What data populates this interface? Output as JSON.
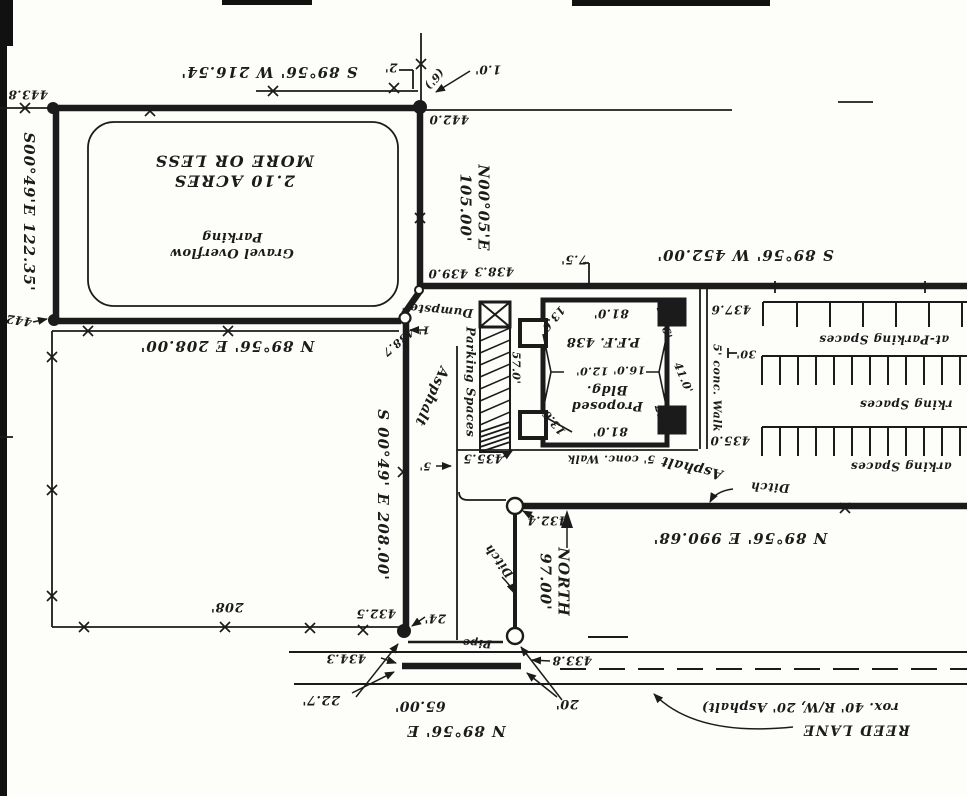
{
  "document": {
    "type": "scanned survey plat / site plan (sheet rotated 180 degrees)",
    "road_name": "REED LANE",
    "parcel_area": "2.10 ACRES MORE OR LESS",
    "ink_color": "#1b1b1b",
    "paper_color": "#fdfdfa"
  },
  "labels": [
    {
      "n": "bearing-top-boundary",
      "t": "S 89°56' W 216.54'",
      "x": 269,
      "y": 72,
      "r": 180,
      "s": 15,
      "ls": 1
    },
    {
      "n": "elev-443-8",
      "t": "443.8",
      "x": 28,
      "y": 94,
      "r": 180,
      "s": 12
    },
    {
      "n": "bearing-west-boundary",
      "t": "S00°49'E 122.35'",
      "x": 29,
      "y": 212,
      "r": 90,
      "s": 15,
      "ls": 1
    },
    {
      "n": "dim-2ft-fence-offset",
      "t": "2'",
      "x": 391,
      "y": 67,
      "r": 180,
      "s": 12
    },
    {
      "n": "dim-6ft-note",
      "t": "(6')",
      "x": 434,
      "y": 79,
      "r": 131,
      "s": 11
    },
    {
      "n": "dim-1-0ft",
      "t": "1.0'",
      "x": 488,
      "y": 69,
      "r": 180,
      "s": 12
    },
    {
      "n": "elev-442-0",
      "t": "442.0",
      "x": 449,
      "y": 119,
      "r": 180,
      "s": 12
    },
    {
      "n": "bearing-ne-boundary",
      "t": "N00°05'E\n105.00'",
      "x": 474,
      "y": 208,
      "r": 90,
      "s": 15,
      "ls": 1
    },
    {
      "n": "parcel-area-note",
      "t": "2.10 ACRES\nMORE OR LESS",
      "x": 234,
      "y": 171,
      "r": 180,
      "s": 16,
      "ls": 1.5
    },
    {
      "n": "parcel-use-note",
      "t": "Gravel Overflow\nParking",
      "x": 232,
      "y": 244,
      "r": 180,
      "s": 13
    },
    {
      "n": "elev-442",
      "t": "442",
      "x": 19,
      "y": 320,
      "r": 188,
      "s": 12
    },
    {
      "n": "bearing-n8956e-208",
      "t": "N 89°56' E 208.00'",
      "x": 227,
      "y": 346,
      "r": 180,
      "s": 15,
      "ls": 1
    },
    {
      "n": "elev-438-7",
      "t": "438.7",
      "x": 398,
      "y": 342,
      "r": 140,
      "s": 11
    },
    {
      "n": "bearing-s0049e-208",
      "t": "S 00°49' E 208.00'",
      "x": 383,
      "y": 495,
      "r": 90,
      "s": 15,
      "ls": 1
    },
    {
      "n": "dim-208",
      "t": "208'",
      "x": 227,
      "y": 606,
      "r": 180,
      "s": 13
    },
    {
      "n": "dumpster-label",
      "t": "Dumpster",
      "x": 438,
      "y": 310,
      "r": 185,
      "s": 12
    },
    {
      "n": "dim-1ft",
      "t": "1'",
      "x": 424,
      "y": 330,
      "r": 180,
      "s": 11
    },
    {
      "n": "parking-strip-label",
      "t": "Parking Spaces",
      "x": 470,
      "y": 382,
      "r": 90,
      "s": 12
    },
    {
      "n": "asphalt-drive-label",
      "t": "Asphalt",
      "x": 431,
      "y": 396,
      "r": 114,
      "s": 14
    },
    {
      "n": "dim-5ft",
      "t": "5'",
      "x": 425,
      "y": 466,
      "r": 180,
      "s": 11
    },
    {
      "n": "elev-439-0",
      "t": "439.0",
      "x": 448,
      "y": 273,
      "r": 180,
      "s": 12
    },
    {
      "n": "elev-438-3",
      "t": "438.3",
      "x": 494,
      "y": 271,
      "r": 180,
      "s": 12
    },
    {
      "n": "dim-7-5ft",
      "t": "7.5'",
      "x": 574,
      "y": 259,
      "r": 180,
      "s": 12
    },
    {
      "n": "bearing-s8956w-452",
      "t": "S 89°56' W 452.00'",
      "x": 745,
      "y": 255,
      "r": 180,
      "s": 15,
      "ls": 1
    },
    {
      "n": "elev-437-6",
      "t": "437.6",
      "x": 731,
      "y": 309,
      "r": 180,
      "s": 12
    },
    {
      "n": "dim-13-6-top",
      "t": "13.6'",
      "x": 552,
      "y": 320,
      "r": 130,
      "s": 11
    },
    {
      "n": "dim-81-0-top",
      "t": "81.0'",
      "x": 611,
      "y": 313,
      "r": 180,
      "s": 12
    },
    {
      "n": "dim-21-6-top",
      "t": "21.6'",
      "x": 664,
      "y": 323,
      "r": 75,
      "s": 11
    },
    {
      "n": "bldg-finished-floor",
      "t": "P.F.F. 438",
      "x": 603,
      "y": 341,
      "r": 180,
      "s": 13
    },
    {
      "n": "dim-57-0",
      "t": "57.0'",
      "x": 516,
      "y": 368,
      "r": 90,
      "s": 11
    },
    {
      "n": "dim-12-0",
      "t": "12.0'",
      "x": 592,
      "y": 371,
      "r": 180,
      "s": 11
    },
    {
      "n": "dim-16-0",
      "t": "16.0'",
      "x": 629,
      "y": 370,
      "r": 180,
      "s": 11
    },
    {
      "n": "dim-41-0",
      "t": "41.0'",
      "x": 683,
      "y": 378,
      "r": 67,
      "s": 11
    },
    {
      "n": "bldg-name",
      "t": "Proposed\nBldg.",
      "x": 607,
      "y": 397,
      "r": 180,
      "s": 13
    },
    {
      "n": "dim-13-6-bottom",
      "t": "13.6'",
      "x": 553,
      "y": 421,
      "r": 230,
      "s": 11
    },
    {
      "n": "dim-81-0-bottom",
      "t": "81.0'",
      "x": 610,
      "y": 431,
      "r": 180,
      "s": 12
    },
    {
      "n": "dim-21-6-bottom",
      "t": "21.6'",
      "x": 662,
      "y": 421,
      "r": 75,
      "s": 11
    },
    {
      "n": "elev-435-5",
      "t": "435.5",
      "x": 483,
      "y": 458,
      "r": 180,
      "s": 12
    },
    {
      "n": "walk-south-label",
      "t": "5' conc. Walk",
      "x": 611,
      "y": 459,
      "r": 180,
      "s": 11
    },
    {
      "n": "asphalt-road-label",
      "t": "Asphalt",
      "x": 692,
      "y": 467,
      "r": 193,
      "s": 14
    },
    {
      "n": "walk-east-label",
      "t": "5' conc. Walk",
      "x": 717,
      "y": 388,
      "r": 90,
      "s": 11
    },
    {
      "n": "dim-30ft",
      "t": "30'",
      "x": 746,
      "y": 354,
      "r": 180,
      "s": 11
    },
    {
      "n": "elev-435-0",
      "t": "435.0",
      "x": 730,
      "y": 440,
      "r": 180,
      "s": 12
    },
    {
      "n": "parking-row1-label",
      "t": "at-Parking Spaces",
      "x": 884,
      "y": 339,
      "r": 180,
      "s": 12
    },
    {
      "n": "parking-row2-label",
      "t": "rking Spaces",
      "x": 906,
      "y": 404,
      "r": 180,
      "s": 12
    },
    {
      "n": "parking-row3-label",
      "t": "arking Spaces",
      "x": 901,
      "y": 466,
      "r": 180,
      "s": 12
    },
    {
      "n": "ditch-east-label",
      "t": "Ditch",
      "x": 770,
      "y": 487,
      "r": 183,
      "s": 12
    },
    {
      "n": "elev-432-4",
      "t": "432.4",
      "x": 547,
      "y": 520,
      "r": 180,
      "s": 12
    },
    {
      "n": "ditch-west-label",
      "t": "Ditch",
      "x": 499,
      "y": 561,
      "r": 232,
      "s": 12
    },
    {
      "n": "bearing-ditch-north",
      "t": "NORTH\n97.00'",
      "x": 554,
      "y": 582,
      "r": 90,
      "s": 15,
      "ls": 1
    },
    {
      "n": "bearing-road-east",
      "t": "N 89°56' E 990.68'",
      "x": 740,
      "y": 538,
      "r": 180,
      "s": 15,
      "ls": 1
    },
    {
      "n": "elev-432-5",
      "t": "432.5",
      "x": 376,
      "y": 613,
      "r": 180,
      "s": 12
    },
    {
      "n": "dim-24ft",
      "t": "24'",
      "x": 435,
      "y": 618,
      "r": 180,
      "s": 12
    },
    {
      "n": "pipe-label",
      "t": "Pipe",
      "x": 477,
      "y": 643,
      "r": 183,
      "s": 11
    },
    {
      "n": "elev-433-8",
      "t": "433.8",
      "x": 572,
      "y": 660,
      "r": 180,
      "s": 12
    },
    {
      "n": "elev-434-3",
      "t": "434.3",
      "x": 346,
      "y": 658,
      "r": 180,
      "s": 12
    },
    {
      "n": "dim-22-7ft",
      "t": "22.7'",
      "x": 321,
      "y": 699,
      "r": 180,
      "s": 13
    },
    {
      "n": "dim-65ft",
      "t": "65.00'",
      "x": 420,
      "y": 705,
      "r": 180,
      "s": 14
    },
    {
      "n": "bearing-road-frontage",
      "t": "N 89°56' E",
      "x": 456,
      "y": 731,
      "r": 180,
      "s": 15,
      "ls": 1
    },
    {
      "n": "dim-20ft",
      "t": "20'",
      "x": 567,
      "y": 703,
      "r": 180,
      "s": 13
    },
    {
      "n": "road-note",
      "t": "rox. 40' R/W, 20' Asphalt)",
      "x": 800,
      "y": 706,
      "r": 180,
      "s": 13
    },
    {
      "n": "road-name",
      "t": "REED LANE",
      "x": 856,
      "y": 729,
      "r": 180,
      "s": 14,
      "ls": 1.5
    }
  ]
}
